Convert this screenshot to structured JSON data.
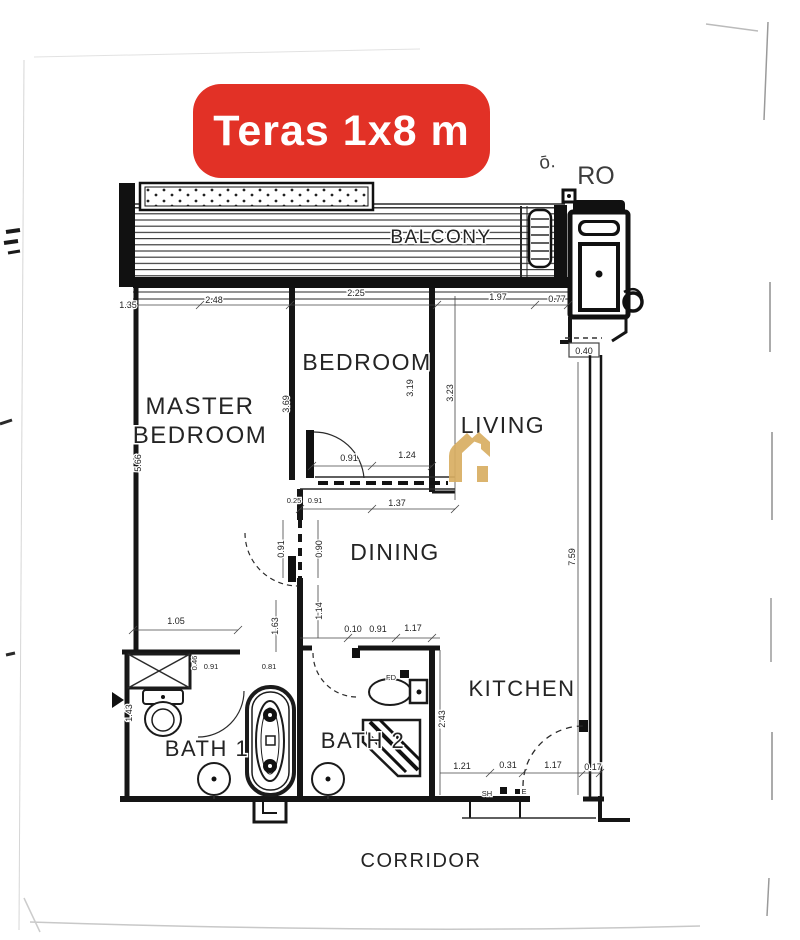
{
  "badge": {
    "label": "Teras 1x8 m",
    "bg_color": "#e23126",
    "text_color": "#ffffff"
  },
  "rooms": {
    "balcony": "BALCONY",
    "master_line1": "MASTER",
    "master_line2": "BEDROOM",
    "bedroom": "BEDROOM",
    "living": "LIVING",
    "dining": "DINING",
    "kitchen": "KITCHEN",
    "bath1": "BATH 1",
    "bath2": "BATH 2",
    "corridor": "CORRIDOR"
  },
  "scribbles": {
    "left": "ō.",
    "right": "RO"
  },
  "small_labels": {
    "floor_drain": "FD",
    "sh": "SH",
    "e": "E"
  },
  "dims": {
    "top_row": [
      "1.35",
      "2.48",
      "2.25",
      "1.97",
      "0.77"
    ],
    "shaft_width": "0.40",
    "master_left_height": "5.66",
    "master_divider_height": "3.69",
    "bedroom_height": "3.19",
    "living_height": "3.23",
    "right_wall_height": "7.59",
    "bedroom_door_row": [
      "0.91",
      "1.24"
    ],
    "bedroom_lower_row": [
      "0.25",
      "0.91",
      "1.37"
    ],
    "dining_col": [
      "0.91",
      "0.90",
      "1.14",
      "1.63"
    ],
    "left_lower_height": "1.43",
    "bath_top_row": [
      "1.05",
      "0.46",
      "0.91",
      "0.81"
    ],
    "hall_row": [
      "0.10",
      "0.91",
      "1.17"
    ],
    "kitchen_height": "2.43",
    "kitchen_row": [
      "1.21",
      "0.31",
      "1.17",
      "0.17"
    ]
  },
  "colors": {
    "accent_red": "#e23126",
    "watermark_gold": "#d8ae62",
    "ink": "#151515",
    "paper": "#ffffff"
  }
}
